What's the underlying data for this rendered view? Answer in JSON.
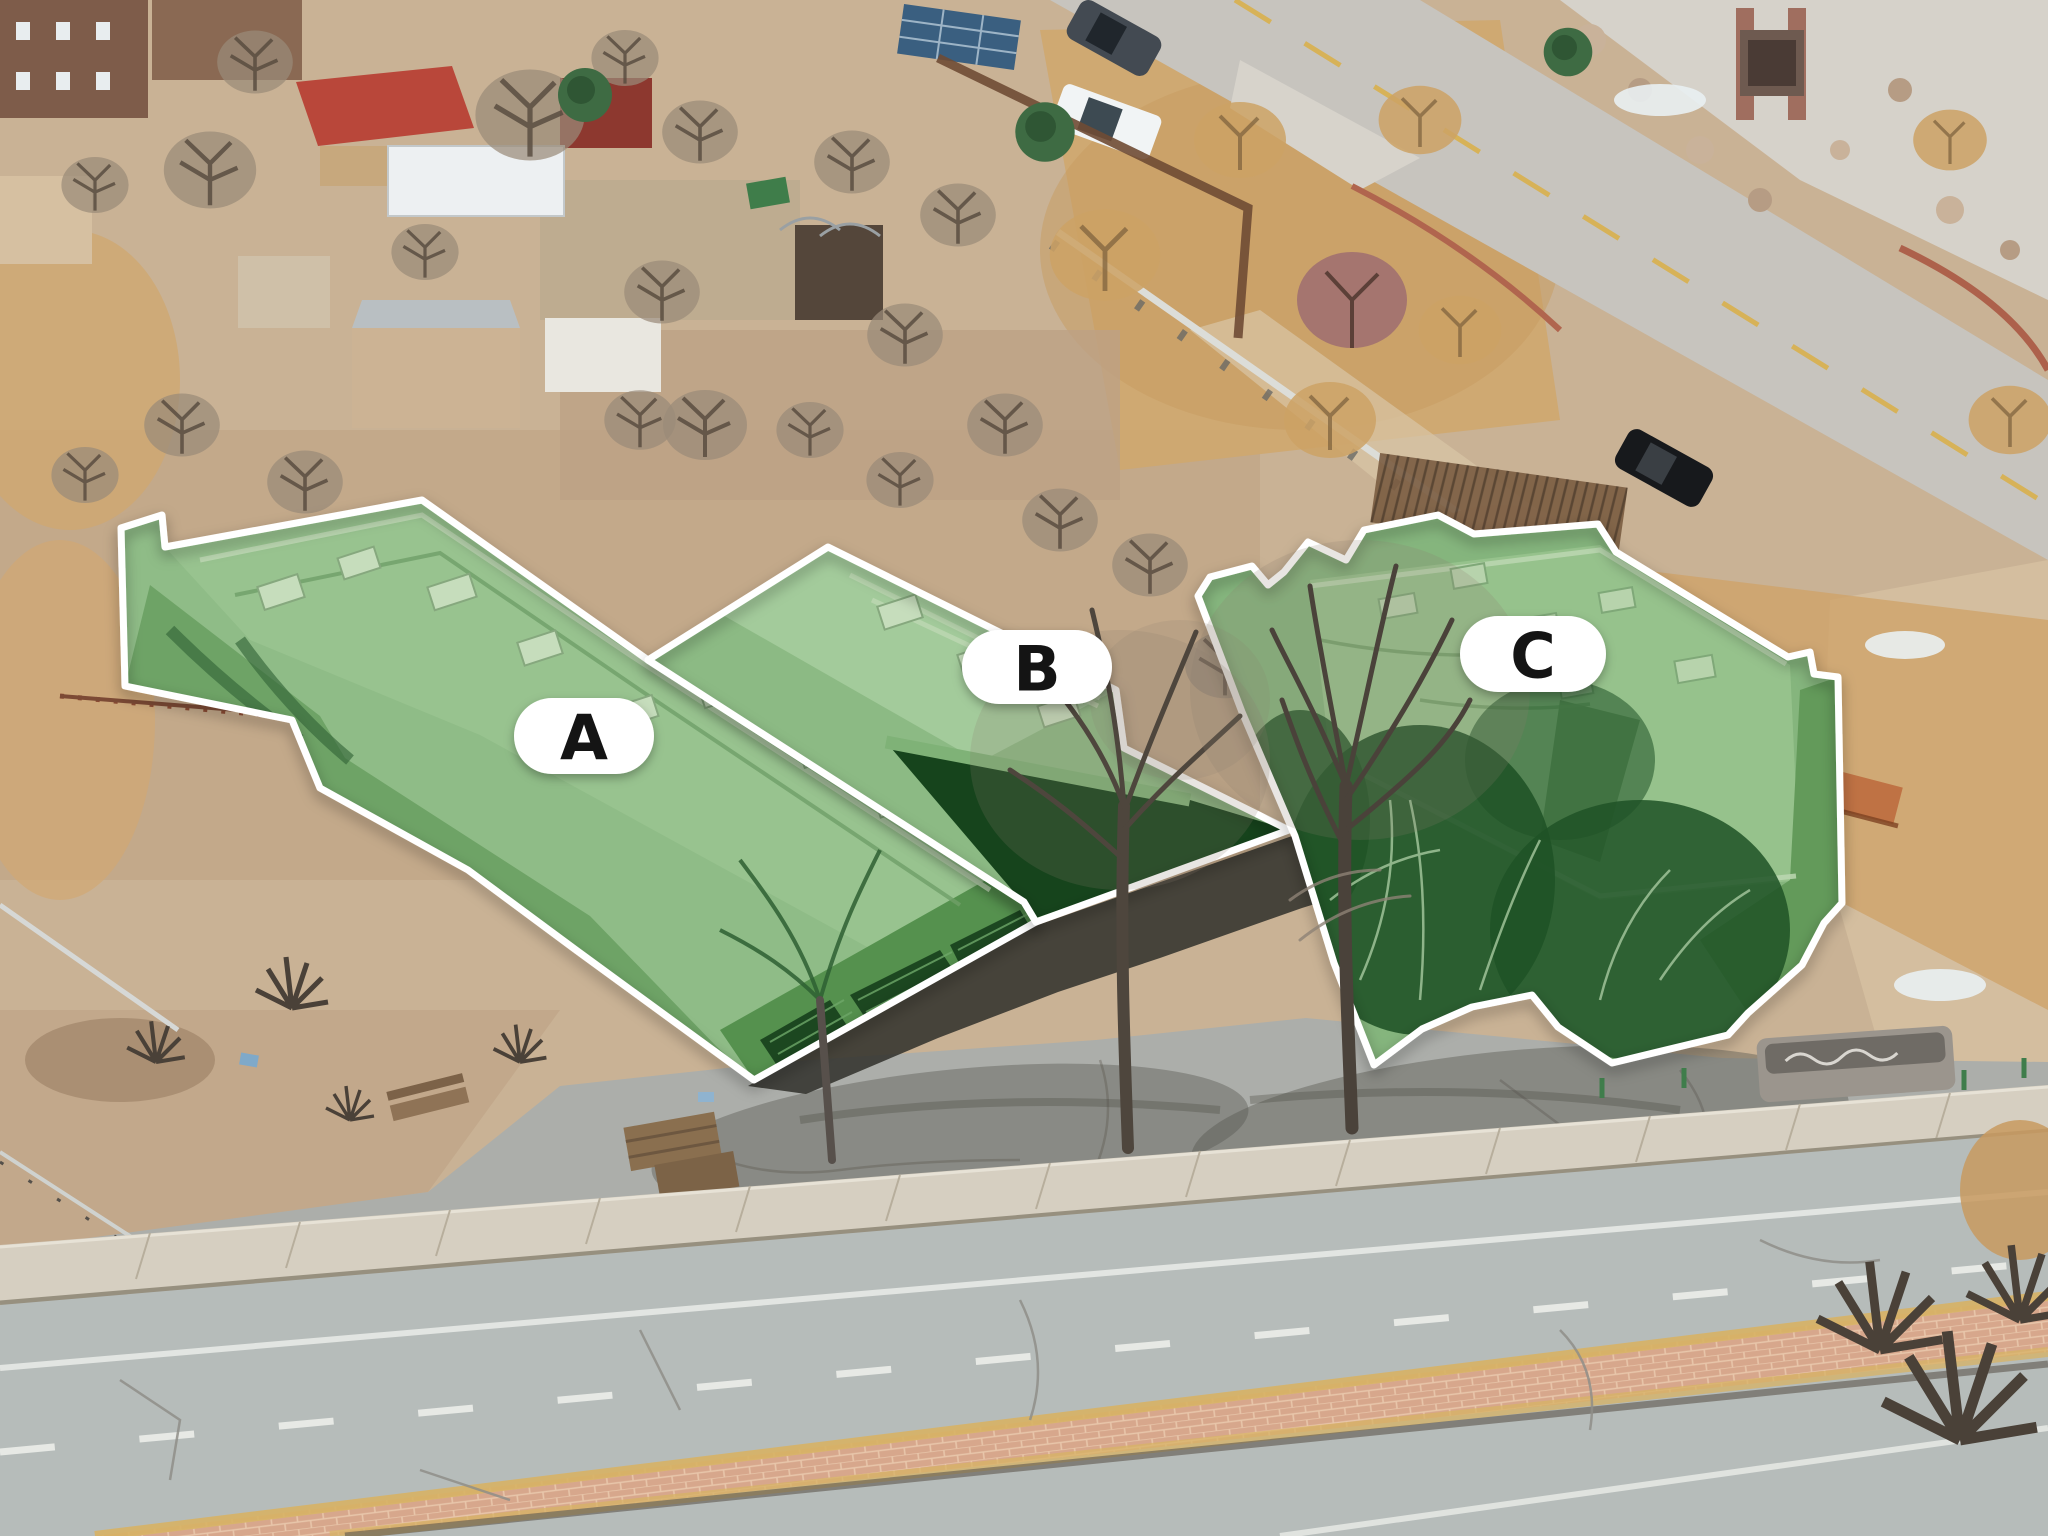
{
  "scene": {
    "kind": "aerial-drone-photograph",
    "subject": "Three adjoining flat-roof buildings highlighted in translucent green between a winter residential neighborhood and a wide arterial road"
  },
  "annotations": [
    {
      "label": "A"
    },
    {
      "label": "B"
    },
    {
      "label": "C"
    }
  ],
  "colors": {
    "highlight_fill": "#8FBC87",
    "highlight_shade": "#1E5226",
    "outline_white": "#FFFFFF",
    "pill_background": "#FFFFFF",
    "pill_text": "#141414",
    "road_gray": "#B6BCBA",
    "median_brick": "#D7A78C",
    "dirt_tan": "#C9B295"
  }
}
